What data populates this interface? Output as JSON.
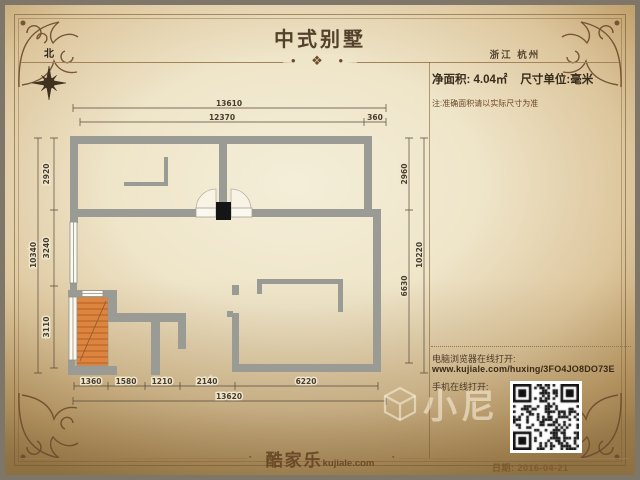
{
  "header": {
    "title": "中式别墅",
    "region": "浙江 杭州"
  },
  "info": {
    "net_area_label": "净面积:  4.04㎡",
    "unit_label": "尺寸单位:毫米",
    "note": "注:准确面积请以实际尺寸为准"
  },
  "plan": {
    "north_label": "北",
    "dims": {
      "top_total": "13610",
      "top_main": "12370",
      "top_offset": "360",
      "left_total": "10340",
      "left_1": "2920",
      "left_2": "3240",
      "left_3": "3110",
      "right_total": "10220",
      "right_1": "2960",
      "right_2": "6630",
      "bottom_1": "1360",
      "bottom_2": "1580",
      "bottom_3": "1210",
      "bottom_4": "2140",
      "bottom_5": "6220",
      "bottom_total": "13620"
    },
    "colors": {
      "wall": "#9b9b95",
      "stairs": "#dd8440",
      "door_column": "#151515"
    }
  },
  "share_panel": {
    "pc_label": "电脑浏览器在线打开:",
    "url": "www.kujiale.com/huxing/3FO4JO8DO73E",
    "mobile_label": "手机在线打开:"
  },
  "footer": {
    "logo_cn": "酷家乐",
    "logo_en": "kujiale.com",
    "date": "日期: 2016-04-21"
  },
  "watermark": {
    "text": "小尼"
  },
  "decor": {
    "divider_glyph": "❖",
    "divider_dot": "•",
    "rule_dot": "▪"
  }
}
